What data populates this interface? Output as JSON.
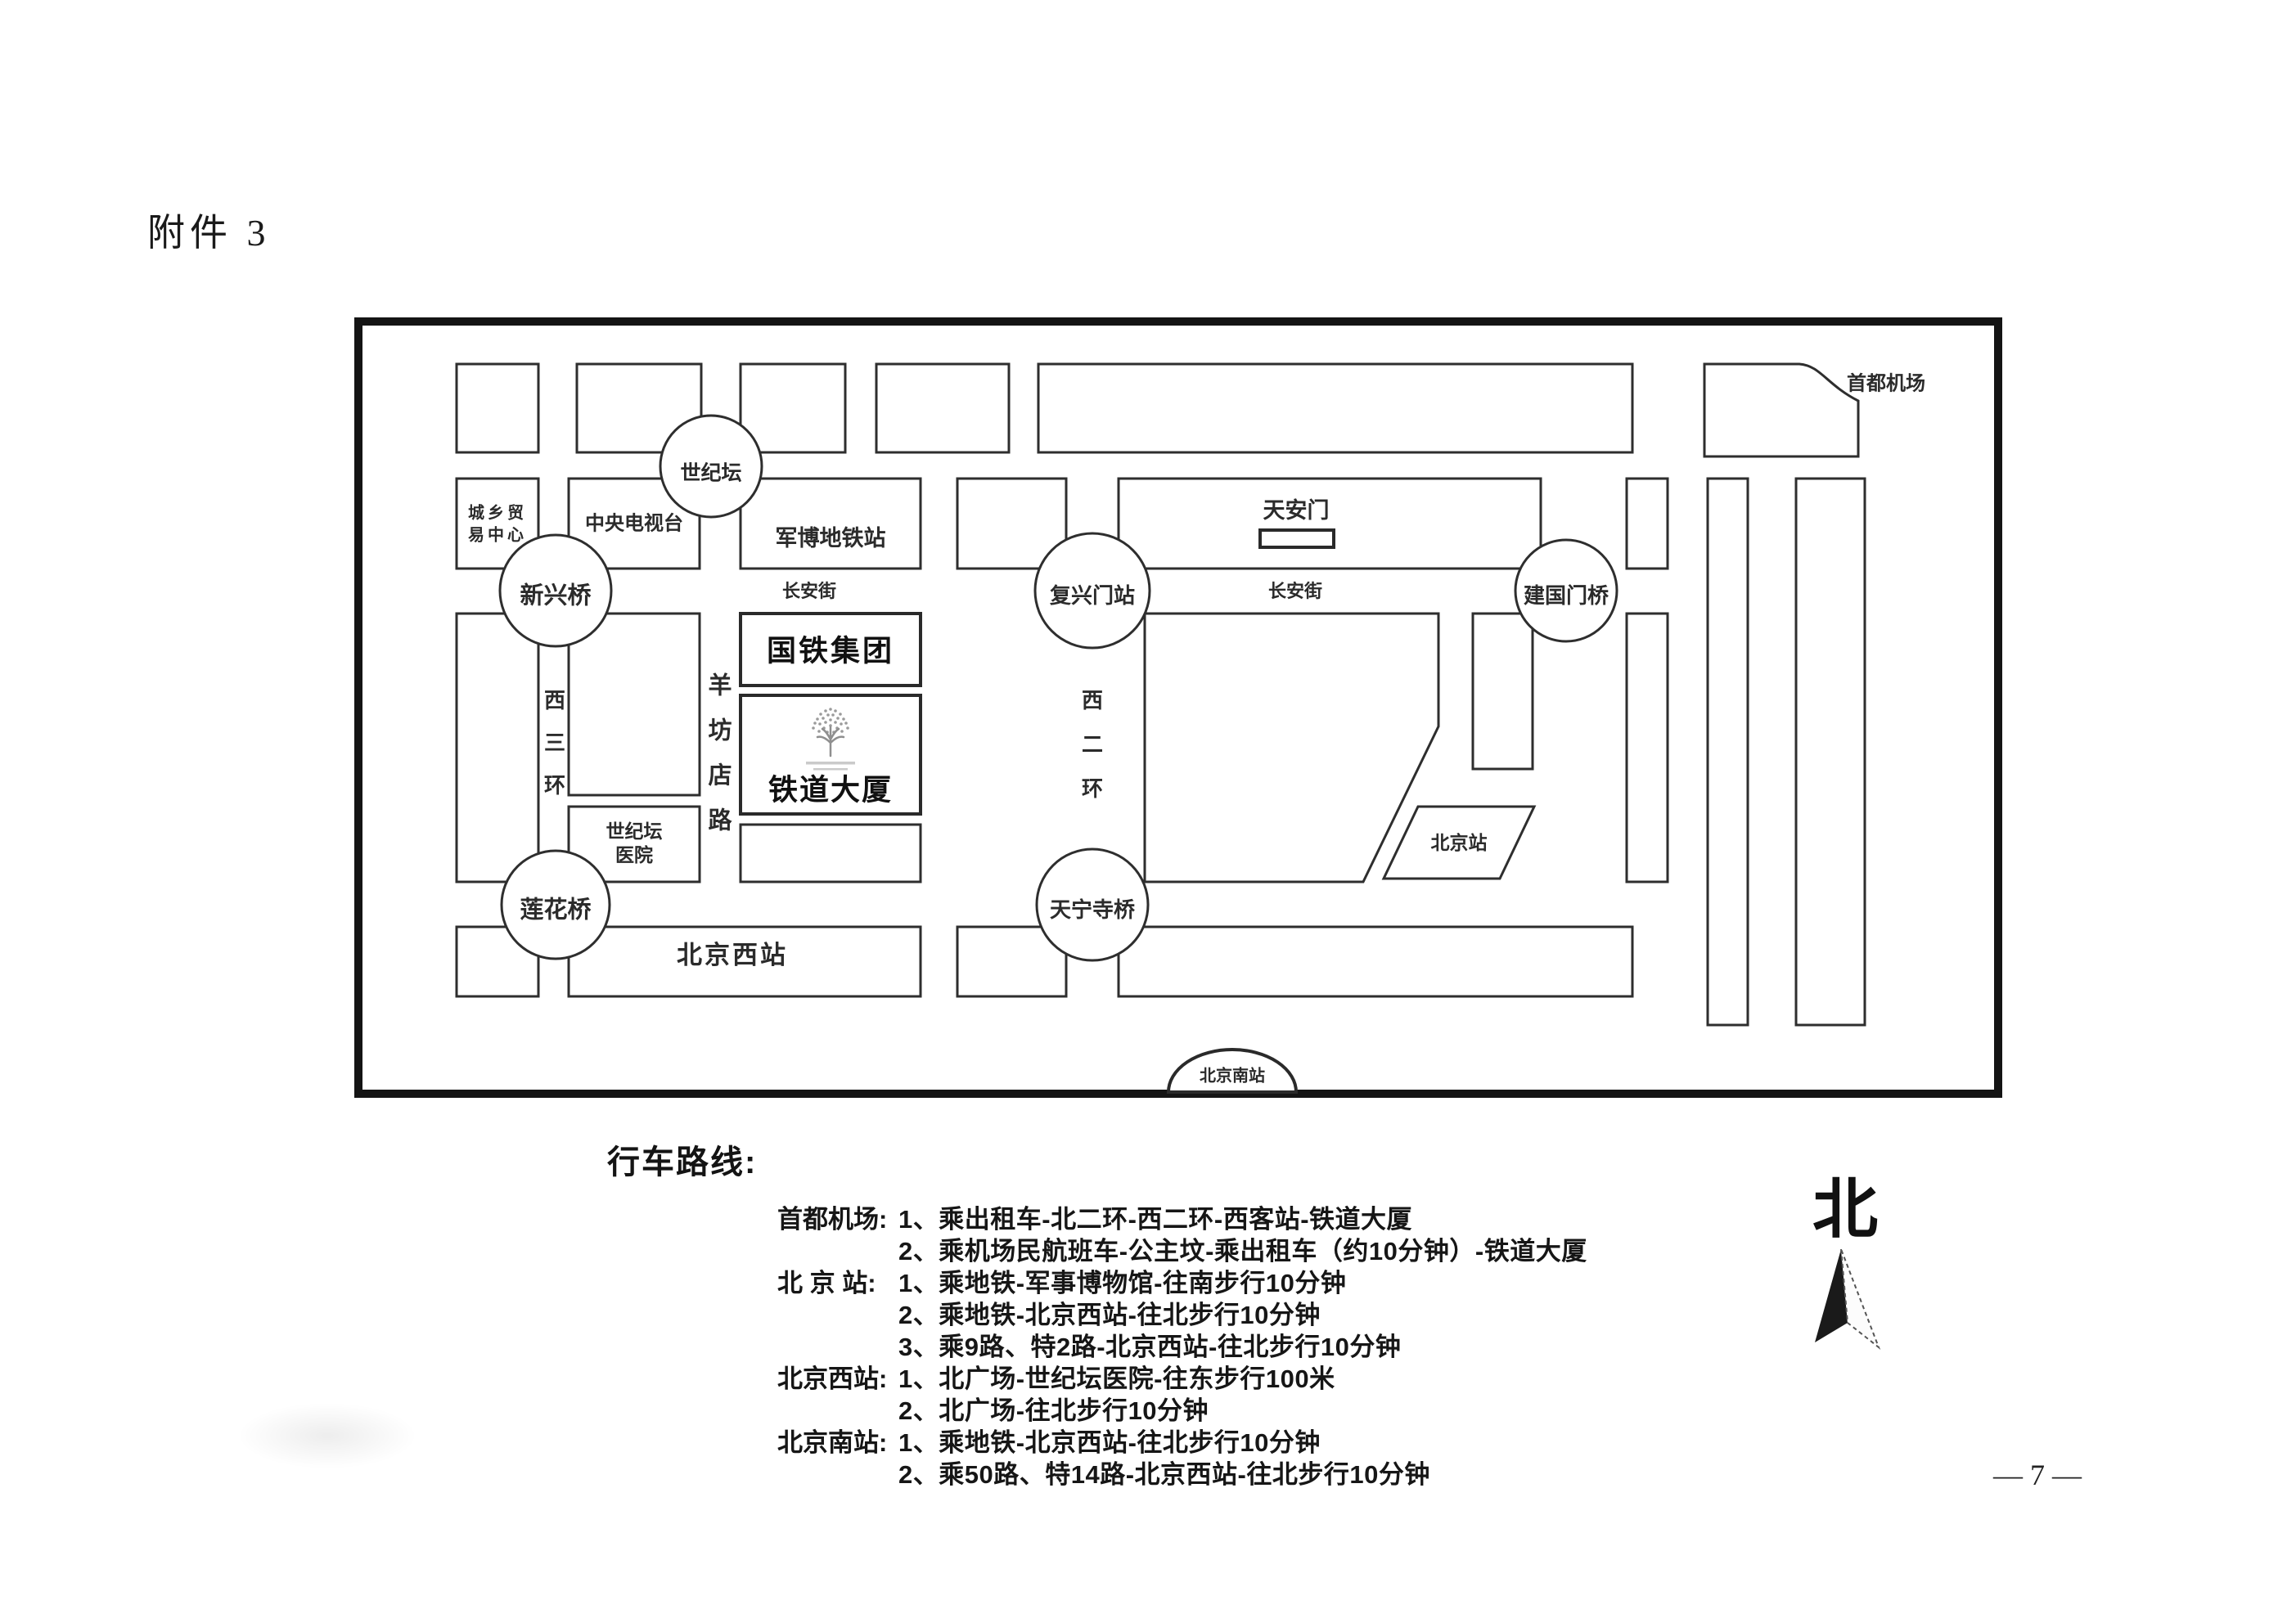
{
  "page": {
    "attachment": "附件 3",
    "page_number": "— 7 —"
  },
  "colors": {
    "ink": "#2e2e2e",
    "border": "#141414"
  },
  "compass": {
    "label": "北"
  },
  "map": {
    "roundabouts": {
      "shijitan": "世纪坛",
      "xinxingqiao": "新兴桥",
      "fuxingmen": "复兴门站",
      "jianguomen": "建国门桥",
      "lianhuaqiao": "莲花桥",
      "tianningsiqiao": "天宁寺桥"
    },
    "places": {
      "chengxiang_line1": "城乡贸",
      "chengxiang_line2": "易中心",
      "cctv": "中央电视台",
      "junbo_station": "军博地铁站",
      "guotie_group": "国铁集团",
      "tiedao_mansion": "铁道大厦",
      "hospital_line1": "世纪坛",
      "hospital_line2": "医院",
      "tiananmen": "天安门",
      "beijing_west_station": "北京西站",
      "beijing_station": "北京站",
      "beijing_south_station": "北京南站",
      "capital_airport": "首都机场"
    },
    "roads": {
      "changan_west": "长安街",
      "changan_east": "长安街",
      "xisanhuan": [
        "西",
        "三",
        "环"
      ],
      "yangfangdianlu": [
        "羊",
        "坊",
        "店",
        "路"
      ],
      "xierhuan": [
        "西",
        "二",
        "环"
      ]
    },
    "icons": {
      "hotel_logo": "tree-logo"
    }
  },
  "directions": {
    "heading": "行车路线:",
    "rows": [
      {
        "station": "首都机场:",
        "route": "1、乘出租车-北二环-西二环-西客站-铁道大厦"
      },
      {
        "station": "",
        "route": "2、乘机场民航班车-公主坟-乘出租车（约10分钟）-铁道大厦"
      },
      {
        "station": "北 京 站:",
        "route": "1、乘地铁-军事博物馆-往南步行10分钟"
      },
      {
        "station": "",
        "route": "2、乘地铁-北京西站-往北步行10分钟"
      },
      {
        "station": "",
        "route": "3、乘9路、特2路-北京西站-往北步行10分钟"
      },
      {
        "station": "北京西站:",
        "route": "1、北广场-世纪坛医院-往东步行100米"
      },
      {
        "station": "",
        "route": "2、北广场-往北步行10分钟"
      },
      {
        "station": "北京南站:",
        "route": "1、乘地铁-北京西站-往北步行10分钟"
      },
      {
        "station": "",
        "route": "2、乘50路、特14路-北京西站-往北步行10分钟"
      }
    ]
  }
}
